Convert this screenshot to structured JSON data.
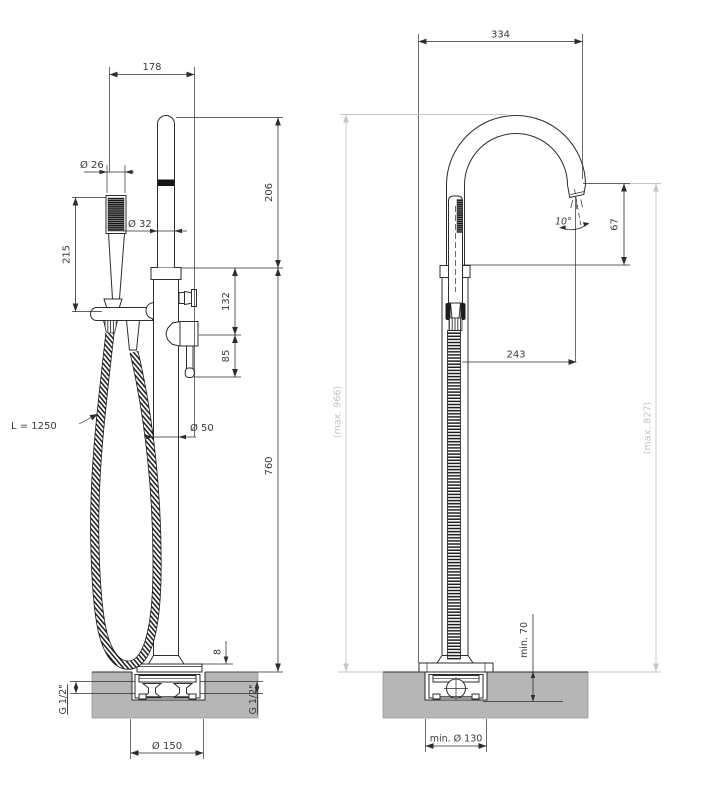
{
  "drawing": {
    "front_view": {
      "top_width": "178",
      "handshower_diameter": "Ø 26",
      "handshower_length": "215",
      "spout_pipe_diameter": "Ø 32",
      "upper_section_height": "206",
      "diverter_offset": "132",
      "handle_drop": "85",
      "hose_length": "L = 1250",
      "column_diameter": "Ø 50",
      "column_height": "760",
      "base_plate_thickness": "8",
      "connection_left": "G 1/2\"",
      "connection_right": "G 1/2\"",
      "base_diameter": "Ø 150"
    },
    "side_view": {
      "spout_reach_overall": "334",
      "spout_angle": "10°",
      "spout_to_column_top": "67",
      "spout_reach": "243",
      "max_height_handshower": "(max. 966)",
      "max_height_spout": "(max. 827)",
      "min_floor_depth": "min. 70",
      "min_recess_diameter": "min. Ø 130"
    },
    "colors": {
      "line": "#2d2d2d",
      "dim_text": "#3a3a3a",
      "reference_gray": "#c7c7c7",
      "floor_gray": "#b6b6b6"
    }
  }
}
